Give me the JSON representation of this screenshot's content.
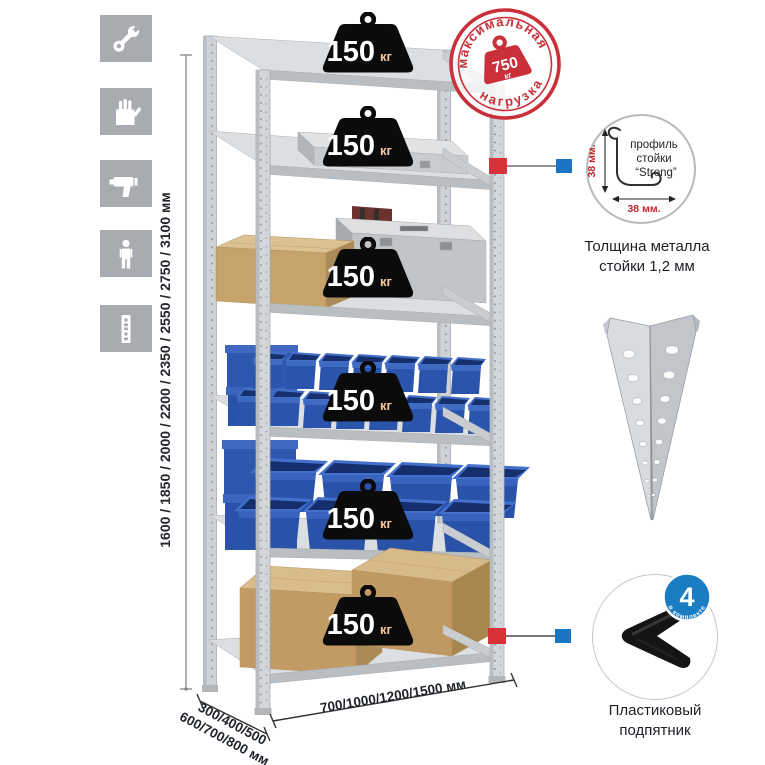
{
  "icons": [
    {
      "name": "wrench-icon"
    },
    {
      "name": "gloves-icon"
    },
    {
      "name": "drill-icon"
    },
    {
      "name": "person-icon"
    },
    {
      "name": "post-profile-icon"
    }
  ],
  "dims": {
    "height_label": "1600 / 1850 / 2000 / 2200 / 2350 / 2550 / 2750 / 3100 мм"
  },
  "badges": [
    {
      "value": "150",
      "unit": "кг"
    },
    {
      "value": "150",
      "unit": "кг"
    },
    {
      "value": "150",
      "unit": "кг"
    },
    {
      "value": "150",
      "unit": "кг"
    },
    {
      "value": "150",
      "unit": "кг"
    },
    {
      "value": "150",
      "unit": "кг"
    }
  ],
  "stamp": {
    "arc_top": "максимальная",
    "arc_bottom": "нагрузка",
    "value": "750",
    "unit": "кг"
  },
  "profile": {
    "label_line1": "профиль",
    "label_line2": "стойки",
    "label_line3": "“Strong”",
    "dim_vertical": "38 мм.",
    "dim_horizontal": "38 мм.",
    "caption_line1": "Толщина металла",
    "caption_line2": "стойки 1,2 мм"
  },
  "foot": {
    "count": "4",
    "count_caption": "в комплекте",
    "caption_line1": "Пластиковый",
    "caption_line2": "подпятник"
  },
  "footprint": {
    "depth_line1": "300/400/500",
    "depth_line2": "600/700/800 мм",
    "width_label": "700/1000/1200/1500 мм"
  },
  "colors": {
    "accent_red": "#c9303a",
    "accent_blue": "#1b74c5",
    "badge_black": "#0b0b0b",
    "bin_blue": "#2b55ad",
    "icon_gray": "#a8abaf"
  }
}
